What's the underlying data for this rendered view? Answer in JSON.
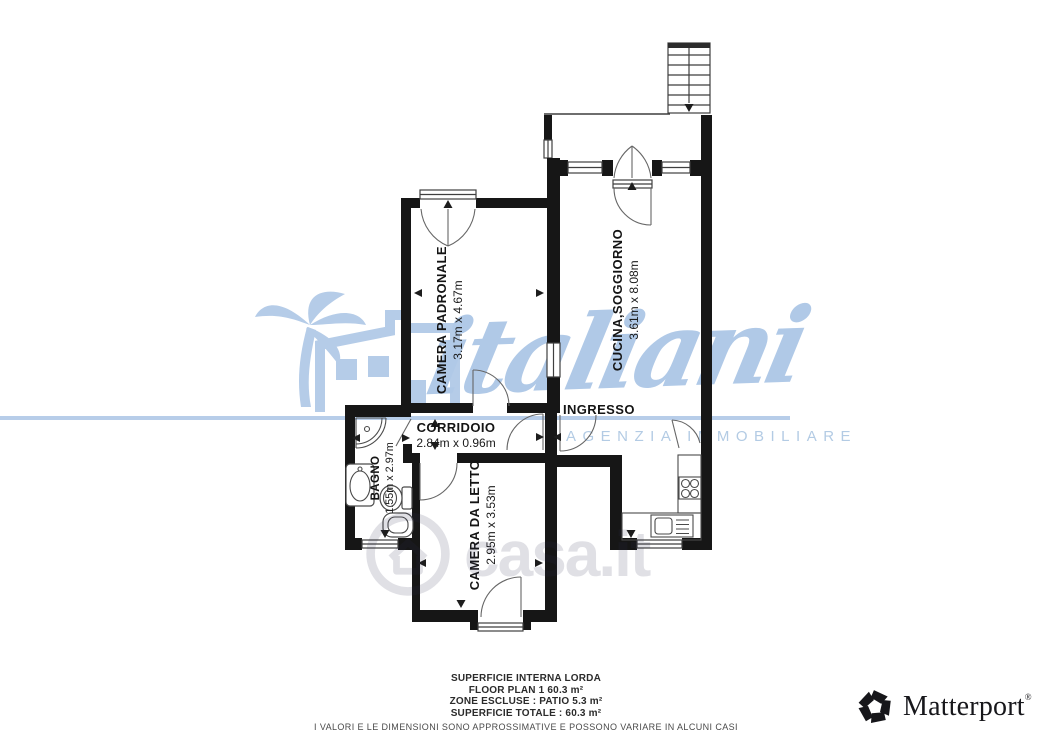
{
  "plan": {
    "rooms": [
      {
        "name": "CAMERA PADRONALE",
        "dims": "3.17m x 4.67m"
      },
      {
        "name": "CUCINA,SOGGIORNO",
        "dims": "3.61m x 8.08m"
      },
      {
        "name": "CORRIDOIO",
        "dims": "2.84m x 0.96m"
      },
      {
        "name": "INGRESSO",
        "dims": ""
      },
      {
        "name": "BAGNO",
        "dims": "1.55m x 2.97m"
      },
      {
        "name": "CAMERA DA LETTO",
        "dims": "2.95m x 3.53m"
      }
    ]
  },
  "watermarks": {
    "agency_name": "italiani",
    "agency_tagline": "AGENZIA IMMOBILIARE",
    "listing_site": "casa.it"
  },
  "footer": {
    "lines": [
      "SUPERFICIE INTERNA LORDA",
      "FLOOR PLAN 1 60.3 m²",
      "ZONE ESCLUSE :  PATIO 5.3 m²",
      "SUPERFICIE TOTALE :  60.3 m²"
    ],
    "disclaimer": "I VALORI E LE DIMENSIONI SONO APPROSSIMATIVE E POSSONO VARIARE IN ALCUNI CASI"
  },
  "branding": {
    "provider": "Matterport",
    "registered": "®"
  },
  "colors": {
    "wall": "#161616",
    "watermark_blue": "#b5cce8",
    "casa_overlay": "rgba(50,50,78,0.15)"
  }
}
